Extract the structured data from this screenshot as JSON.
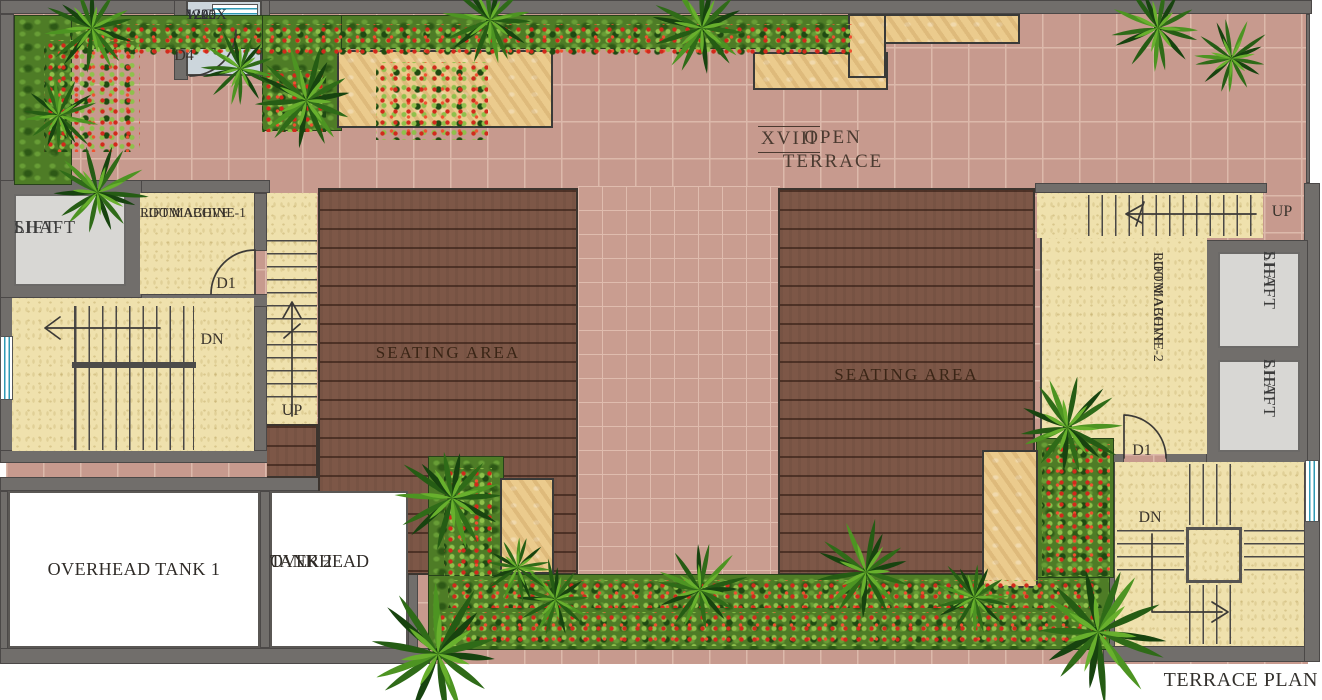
{
  "plan": {
    "caption": "TERRACE PLAN",
    "terrace_label": "OPEN TERRACE",
    "terrace_numeral": "XVIII"
  },
  "rooms": {
    "wc": {
      "name": "W.C.",
      "dim1": "1200X",
      "dim2": "1225"
    },
    "lift_shaft_left": {
      "line1": "LIFT",
      "line2": "SHAFT"
    },
    "lift_machine_room_1": {
      "line1": "LIFT MACHINE-1",
      "line2": "ROOM  ABOVE"
    },
    "lift_machine_room_2": {
      "line1": "LIFT MACHINE-2",
      "line2": "ROOM  ABOVE"
    },
    "lift_shaft_right_top": {
      "line1": "LIFT",
      "line2": "SHAFT"
    },
    "lift_shaft_right_bottom": {
      "line1": "LIFT",
      "line2": "SHAFT"
    },
    "seating_area_left": "SEATING AREA",
    "seating_area_right": "SEATING AREA",
    "overhead_tank_1": "OVERHEAD TANK 1",
    "overhead_tank_2": {
      "line1": "OVERHEAD",
      "line2": "TANK 2"
    }
  },
  "doors": {
    "d4": "D4",
    "d1_left": "D1",
    "d1_right": "D1"
  },
  "stairs": {
    "left_down": "DN",
    "left_up": "UP",
    "right_up": "UP",
    "right_down": "DN"
  },
  "colors": {
    "tile": "#c79a8e",
    "tileLine": "#dcb9ab",
    "tileSm": "#c99d90",
    "tileSmLine": "#dfbcae",
    "wall": "#716e6b",
    "wallEdge": "#4b4847",
    "beige": "#efe1ad",
    "deck": "#7d5747",
    "green": "#4e7c26",
    "flowerRed": "#d2291c",
    "tan": "#ebcb8d",
    "shaft": "#d8d7d4",
    "wc": "#ccd6dc",
    "tank": "#ffffff",
    "ink": "#39332c",
    "windowBlue": "#2f9ab5"
  }
}
